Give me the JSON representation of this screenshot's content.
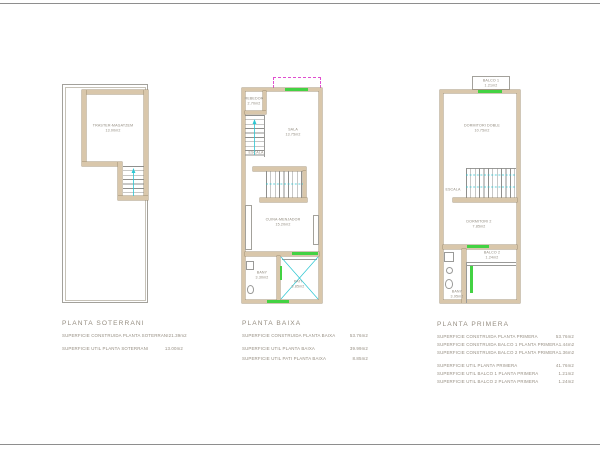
{
  "colors": {
    "wall_fill": "#d9c7ab",
    "wall_edge": "#a08f72",
    "window_green": "#43d243",
    "stair_cyan": "#2cc6d2",
    "dashed_magenta": "#e14fd0",
    "title_text": "#968e82",
    "label_text": "#8f887c"
  },
  "plans": [
    {
      "title": "PLANTA SOTERRANI",
      "rooms": [
        {
          "name": "TRASTER-MAGATZEM",
          "area": "13.00m2"
        }
      ],
      "table": [
        {
          "label": "SUPERFICIE CONSTRUIDA PLANTA SOTERRANI",
          "value": "21.39m2"
        },
        {
          "label": "SUPERFICIE UTIL PLANTA SOTERRANI",
          "value": "13.00m2"
        }
      ]
    },
    {
      "title": "PLANTA BAIXA",
      "rooms": [
        {
          "name": "REBEDOR",
          "area": "2.70m2"
        },
        {
          "name": "SALA",
          "area": "13.75m2"
        },
        {
          "name": "ESCALA",
          "area": ""
        },
        {
          "name": "CUINA-MENJADOR",
          "area": "15.20m2"
        },
        {
          "name": "BANY",
          "area": "3.30m2"
        },
        {
          "name": "PATI",
          "area": "8.85m2"
        }
      ],
      "table": [
        {
          "label": "SUPERFICIE CONSTRUIDA PLANTA BAIXA",
          "value": "53.76m2"
        },
        {
          "label": "SUPERFICIE UTIL PLANTA BAIXA",
          "value": "39.99m2"
        },
        {
          "label": "SUPERFICIE UTIL PATI PLANTA BAIXA",
          "value": "8.85m2"
        }
      ]
    },
    {
      "title": "PLANTA PRIMERA",
      "rooms": [
        {
          "name": "BALCO 1",
          "area": "1.21m2"
        },
        {
          "name": "DORMITORI DOBLE",
          "area": "10.75m2"
        },
        {
          "name": "ESCALA",
          "area": ""
        },
        {
          "name": "DORMITORI 2",
          "area": "7.85m2"
        },
        {
          "name": "BANY",
          "area": "3.95m2"
        },
        {
          "name": "BALCO 2",
          "area": "1.24m2"
        }
      ],
      "table": [
        {
          "label": "SUPERFICIE CONSTRUIDA PLANTA PRIMERA",
          "value": "53.76m2"
        },
        {
          "label": "SUPERFICIE CONSTRUIDA BALCO 1 PLANTA PRIMERA",
          "value": "1.44m2"
        },
        {
          "label": "SUPERFICIE CONSTRUIDA BALCO 2 PLANTA PRIMERA",
          "value": "1.36m2"
        },
        {
          "label": "SUPERFICIE UTIL PLANTA PRIMERA",
          "value": "41.76m2"
        },
        {
          "label": "SUPERFICIE UTIL BALCO 1 PLANTA PRIMERA",
          "value": "1.21m2"
        },
        {
          "label": "SUPERFICIE UTIL BALCO 2 PLANTA PRIMERA",
          "value": "1.24m2"
        }
      ]
    }
  ]
}
